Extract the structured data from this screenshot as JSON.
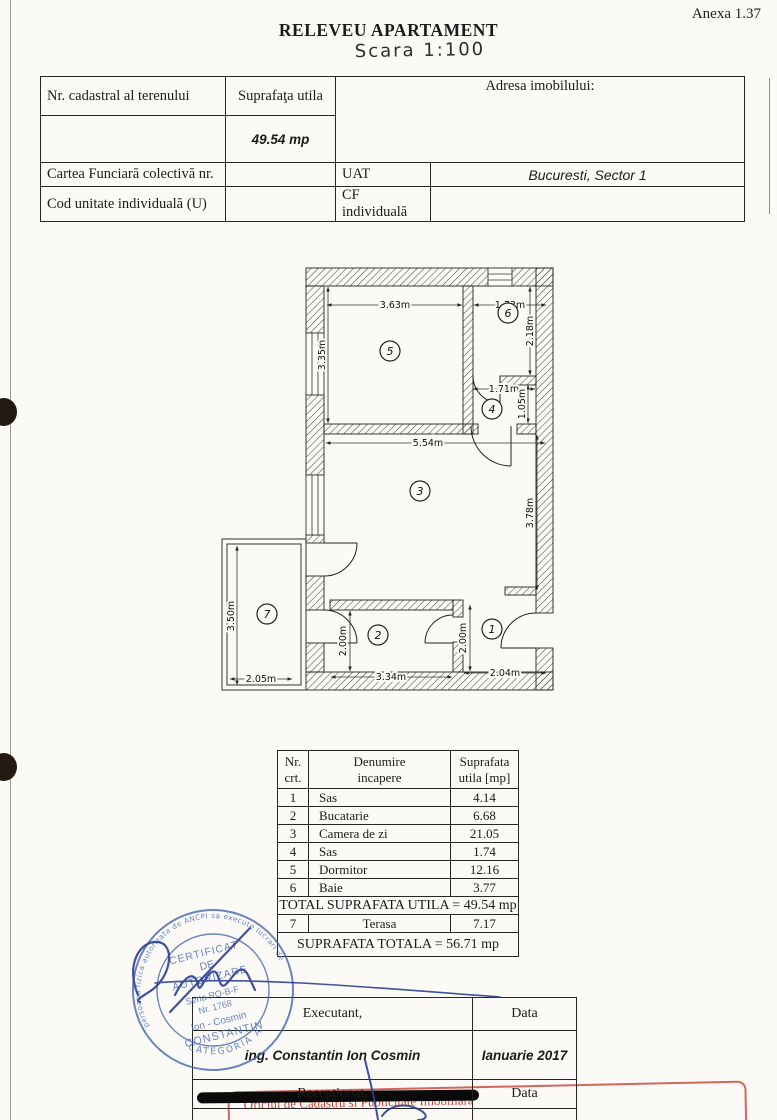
{
  "page": {
    "annex": "Anexa 1.37",
    "title": "RELEVEU APARTAMENT",
    "scale": "Scara 1:100"
  },
  "info_table": {
    "col1_header": "Nr. cadastral al terenului",
    "col2_header": "Suprafaţa utila",
    "col3_header": "Adresa imobilului:",
    "suprafata_value": "49.54  mp",
    "row3_label": "Cartea Funciară colectivă nr.",
    "row3_key": "UAT",
    "row3_value": "Bucuresti, Sector 1",
    "row4_label": "Cod unitate individuală (U)",
    "row4_key": "CF individuală",
    "row4_value": ""
  },
  "plan": {
    "rooms": [
      {
        "number": "1"
      },
      {
        "number": "2"
      },
      {
        "number": "3"
      },
      {
        "number": "4"
      },
      {
        "number": "5"
      },
      {
        "number": "6"
      },
      {
        "number": "7"
      }
    ],
    "dims": [
      {
        "label": "3.63m"
      },
      {
        "label": "1.73m"
      },
      {
        "label": "3.35m"
      },
      {
        "label": "2.18m"
      },
      {
        "label": "1.71m"
      },
      {
        "label": "1.05m"
      },
      {
        "label": "5.54m"
      },
      {
        "label": "3.78m"
      },
      {
        "label": "3.50m"
      },
      {
        "label": "2.00m"
      },
      {
        "label": "2.00m"
      },
      {
        "label": "2.05m"
      },
      {
        "label": "3.34m"
      },
      {
        "label": "2.04m"
      }
    ]
  },
  "rooms_table": {
    "headers": {
      "col1": [
        "Nr.",
        "crt."
      ],
      "col2": [
        "Denumire",
        "incapere"
      ],
      "col3": [
        "Suprafata",
        "utila [mp]"
      ]
    },
    "rows": [
      {
        "nr": "1",
        "name": "Sas",
        "area": "4.14"
      },
      {
        "nr": "2",
        "name": "Bucatarie",
        "area": "6.68"
      },
      {
        "nr": "3",
        "name": "Camera de zi",
        "area": "21.05"
      },
      {
        "nr": "4",
        "name": "Sas",
        "area": "1.74"
      },
      {
        "nr": "5",
        "name": "Dormitor",
        "area": "12.16"
      },
      {
        "nr": "6",
        "name": "Baie",
        "area": "3.77"
      }
    ],
    "total_utila": "TOTAL SUPRAFATA UTILA = 49.54 mp",
    "terasa": {
      "nr": "7",
      "name": "Terasa",
      "area": "7.17"
    },
    "total": "SUPRAFATA TOTALA = 56.71 mp"
  },
  "stamp": {
    "ring_top": "persoana fizica autorizata de ANCPI sa execute lucrari de",
    "line1": "CERTIFICAT",
    "line2": "DE",
    "line3": "AUTORIZARE",
    "line4": "Seria RO-B-F",
    "line5": "Nr. 1768",
    "line6": "Ion - Cosmin",
    "line7": "CONSTANTIN",
    "ring_bottom": "CATEGORIA A"
  },
  "sign_table": {
    "executant_label": "Executant,",
    "data_label_1": "Data",
    "executant_value": "ing. Constantin Ion Cosmin",
    "data_value": "Ianuarie 2017",
    "receptionat_label": "Recepţionat,",
    "data_label_2": "Data"
  },
  "red_stamp": {
    "line": "Oficiul de Cadastru si Publicitate Imobiliara"
  }
}
